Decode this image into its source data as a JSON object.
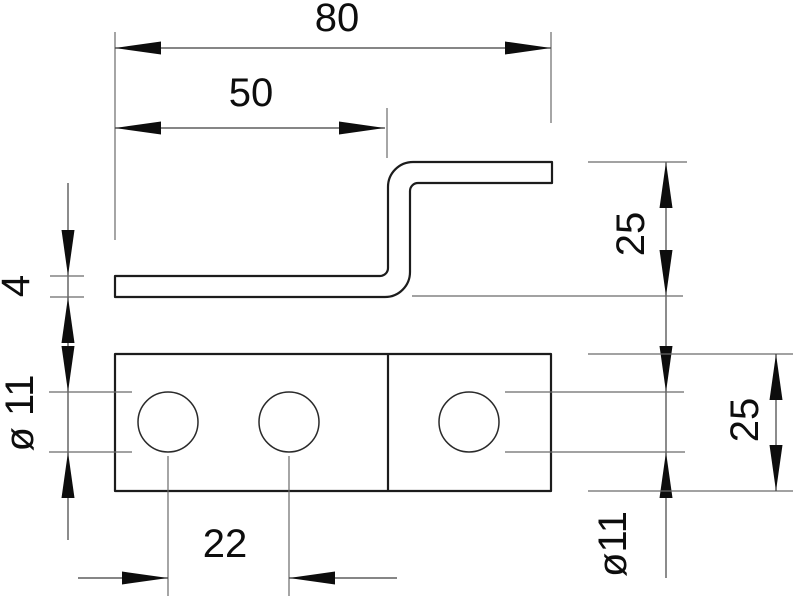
{
  "drawing": {
    "dimension_labels": {
      "total_width": "80",
      "bend_offset": "50",
      "thickness": "4",
      "hole_diameter_side": "ø 11",
      "hole_spacing": "22",
      "profile_height": "25",
      "hole_diameter_plan": "ø11",
      "plate_depth": "25"
    },
    "colors": {
      "background": "#ffffff",
      "part_outline": "#1c1c1c",
      "extension_line": "#6a6a6a",
      "dimension_line": "#3f3f3f",
      "arrow_fill": "#0d0d0d",
      "text": "#0d0d0d"
    }
  }
}
